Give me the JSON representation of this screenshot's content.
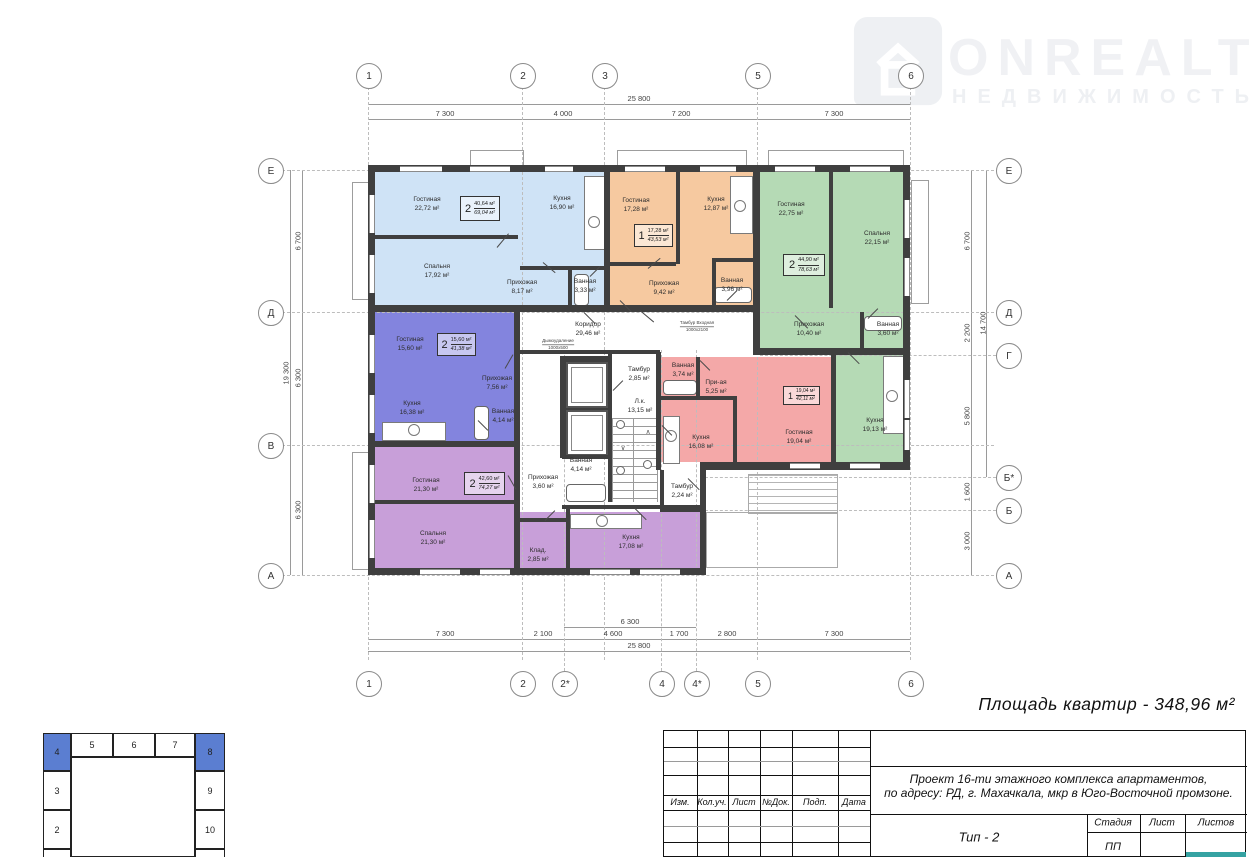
{
  "logo": {
    "title": "ONREALT",
    "subtitle": "НЕДВИЖИМОСТЬ"
  },
  "summary": "Площадь квартир - 348,96 м²",
  "axes": {
    "top": [
      "1",
      "2",
      "3",
      "5",
      "6"
    ],
    "bottom": [
      "1",
      "2",
      "2*",
      "4",
      "4*",
      "5",
      "6"
    ],
    "left": [
      "Е",
      "Д",
      "В",
      "А"
    ],
    "right": [
      "Е",
      "Д",
      "Г",
      "Б*",
      "Б",
      "А"
    ]
  },
  "dims": {
    "top": {
      "total": "25 800",
      "seg": [
        "7 300",
        "4 000",
        "7 200",
        "7 300"
      ]
    },
    "bottom": {
      "inner": "6 300",
      "seg": [
        "7 300",
        "2 100",
        "4 600",
        "1 700",
        "2 800",
        "7 300"
      ],
      "total": "25 800"
    },
    "left": {
      "total": "19 300",
      "seg": [
        "6 700",
        "6 300",
        "6 300"
      ]
    },
    "right": {
      "total": "14 700",
      "seg": [
        "6 700",
        "2 200",
        "5 800",
        "1 600",
        "3 000"
      ]
    }
  },
  "apartments": [
    {
      "id": "blue",
      "color": "#cfe3f6",
      "unit": {
        "rooms": "2",
        "living": "40,64 м²",
        "total": "69,04 м²"
      },
      "rooms": [
        {
          "n": "Гостиная",
          "a": "22,72 м²"
        },
        {
          "n": "Кухня",
          "a": "16,90 м²"
        },
        {
          "n": "Спальня",
          "a": "17,92 м²"
        },
        {
          "n": "Прихожая",
          "a": "8,17 м²"
        },
        {
          "n": "Ванная",
          "a": "3,33 м²"
        }
      ]
    },
    {
      "id": "orange",
      "color": "#f6c9a0",
      "unit": {
        "rooms": "1",
        "living": "17,28 м²",
        "total": "43,53 м²"
      },
      "rooms": [
        {
          "n": "Гостиная",
          "a": "17,28 м²"
        },
        {
          "n": "Кухня",
          "a": "12,87 м²"
        },
        {
          "n": "Прихожая",
          "a": "9,42 м²"
        },
        {
          "n": "Ванная",
          "a": "3,96 м²"
        }
      ]
    },
    {
      "id": "green",
      "color": "#b5dab5",
      "unit": {
        "rooms": "2",
        "living": "44,90 м²",
        "total": "78,63 м²"
      },
      "rooms": [
        {
          "n": "Гостиная",
          "a": "22,75 м²"
        },
        {
          "n": "Спальня",
          "a": "22,15 м²"
        },
        {
          "n": "Прихожая",
          "a": "10,40 м²"
        },
        {
          "n": "Ванная",
          "a": "3,60 м²"
        },
        {
          "n": "Кухня",
          "a": "19,13 м²"
        }
      ]
    },
    {
      "id": "periwinkle",
      "color": "#8384de",
      "unit": {
        "rooms": "2",
        "living": "15,60 м²",
        "total": "41,38 м²"
      },
      "rooms": [
        {
          "n": "Гостиная",
          "a": "15,60 м²"
        },
        {
          "n": "Кухня",
          "a": "16,38 м²"
        },
        {
          "n": "Прихожая",
          "a": "7,56 м²"
        },
        {
          "n": "Ванная",
          "a": "4,14 м²"
        }
      ]
    },
    {
      "id": "pink",
      "color": "#f4a8a8",
      "unit": {
        "rooms": "1",
        "living": "19,04 м²",
        "total": "42,11 м²"
      },
      "rooms": [
        {
          "n": "Ванная",
          "a": "3,74 м²"
        },
        {
          "n": "При-ая",
          "a": "5,25 м²"
        },
        {
          "n": "Кухня",
          "a": "16,08 м²"
        },
        {
          "n": "Гостиная",
          "a": "19,04 м²"
        }
      ]
    },
    {
      "id": "violet",
      "color": "#c89fd9",
      "unit": {
        "rooms": "2",
        "living": "42,60 м²",
        "total": "74,27 м²"
      },
      "rooms": [
        {
          "n": "Гостиная",
          "a": "21,30 м²"
        },
        {
          "n": "Спальня",
          "a": "21,30 м²"
        },
        {
          "n": "Клад.",
          "a": "2,85 м²"
        },
        {
          "n": "Кухня",
          "a": "17,08 м²"
        }
      ]
    }
  ],
  "core": [
    {
      "n": "Коридор",
      "a": "29,46 м²"
    },
    {
      "n": "Тамбур",
      "a": "2,85 м²"
    },
    {
      "n": "Л.к.",
      "a": "13,15 м²"
    },
    {
      "n": "Ванная",
      "a": "4,14 м²"
    },
    {
      "n": "Прихожая",
      "a": "3,60 м²"
    },
    {
      "n": "Тамбур",
      "a": "2,24 м²"
    }
  ],
  "notes": [
    {
      "t": "Дымоудаление",
      "s": "1000х500"
    },
    {
      "t": "Тамбур Входная",
      "s": "1000х2100"
    }
  ],
  "title_block": {
    "cols": [
      "Изм.",
      "Кол.уч.",
      "Лист",
      "№Док.",
      "Подп.",
      "Дата"
    ],
    "project_line1": "Проект 16-ти этажного комплекса апартаментов,",
    "project_line2": "по адресу: РД, г. Махачкала, мкр в Юго-Восточной промзоне.",
    "type": "Тип - 2",
    "stage_cols": [
      "Стадия",
      "Лист",
      "Листов"
    ],
    "stage_value": "ПП"
  },
  "schema": {
    "top": [
      "4",
      "5",
      "6",
      "7",
      "8"
    ],
    "left": [
      "3",
      "2"
    ],
    "right": [
      "9",
      "10"
    ]
  }
}
